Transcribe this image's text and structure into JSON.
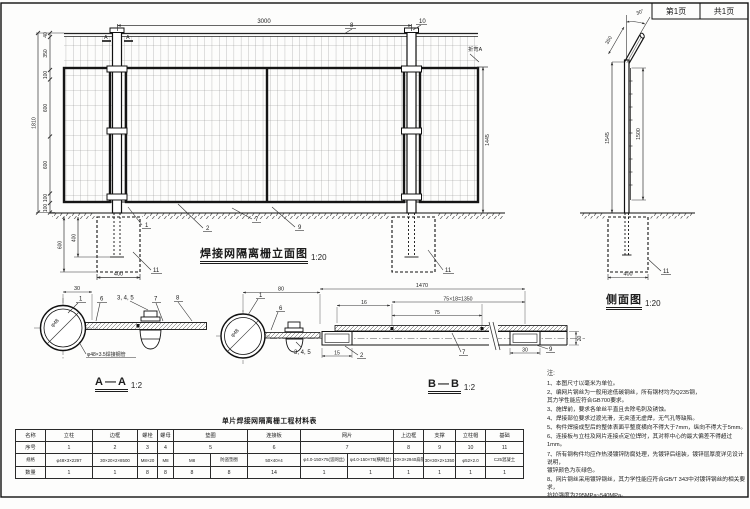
{
  "header": {
    "page": "第1页",
    "total": "共1页"
  },
  "elevation": {
    "title": "焊接网隔离栅立面图",
    "scale": "1:20",
    "dim_top": "3000",
    "dims_left": [
      "40",
      "350",
      "100",
      "600",
      "600",
      "100",
      "100"
    ],
    "dim_overall": "1810",
    "dim_right": "1445",
    "bend_label": "折弯A",
    "cut_a": "A",
    "callouts": {
      "c8": "8",
      "c10": "10",
      "c1": "1",
      "c2": "2",
      "c7": "7",
      "c9": "9",
      "c11l": "11",
      "c11r": "11"
    },
    "found": {
      "embed": "400",
      "depth": "600",
      "width": "400"
    }
  },
  "side": {
    "title": "侧面图",
    "scale": "1:20",
    "angle": "30°",
    "bend_len": "350",
    "h_post": "1545",
    "h_mesh": "1500",
    "found_width": "400",
    "c11": "11"
  },
  "aa": {
    "title": "A—A",
    "scale": "1:2",
    "dim30": "30",
    "pipe": "φ48",
    "pipe_label": "φ48×3.5焊接钢管",
    "callouts": {
      "c1": "1",
      "c6": "6",
      "c345": "3, 4, 5",
      "c7": "7",
      "c8": "8"
    }
  },
  "bb": {
    "title": "B—B",
    "scale": "1:2",
    "pipe": "φ48",
    "dims": {
      "d80": "80",
      "d1470": "1470",
      "d16": "16",
      "d1350": "75×18=1350",
      "d75": "75",
      "d15": "15",
      "d30": "30",
      "d20": "20"
    },
    "callouts": {
      "c1": "1",
      "c6": "6",
      "c345": "3, 4, 5",
      "c2": "2",
      "c7": "7",
      "c9": "9"
    }
  },
  "notes": {
    "heading": "注:",
    "items": [
      "1、本图尺寸以毫米为单位。",
      "2、编网片钢丝为一般用途低碳钢丝，所有钢材均为Q235钢，\n其力学性能应符合GB700要求。",
      "3、施焊前，要求各单丝平直且去除毛刺及锈蚀。",
      "4、焊接部位要求过渡光滑，无夹渣无虚焊，无气孔等缺陷。",
      "5、构件焊接成型后的整体表面平整度横向不得大于7mm，纵向不得大于5mm。",
      "6、连接板与立柱及网片连接点定位焊时，其对称中心的最大偏差不得超过1mm。",
      "7、所有钢构件均应作热浸镀锌防腐处理，先镀锌后组装，镀锌层厚度详见设计说明，\n镀锌颜色为灰绿色。",
      "8、网片钢丝采用镀锌钢丝，其力学性能应符合GB/T 343中对镀锌钢丝的相关要求，\n抗拉强度为295MPa~540MPa。"
    ]
  },
  "table": {
    "title": "单片焊接网隔离栅工程材料表",
    "row_labels": [
      "名称",
      "序号",
      "规格",
      "数量"
    ],
    "names": [
      "立柱",
      "边框",
      "螺栓",
      "螺母",
      "垫圈",
      "连接板",
      "网片",
      "上边框",
      "支撑",
      "立柱帽",
      "基础"
    ],
    "numbers": [
      "1",
      "2",
      "3",
      "4",
      "5",
      "6",
      "7",
      "8",
      "9",
      "10",
      "11"
    ],
    "specs": [
      "φ48×3×2297",
      "30×20×2×8500",
      "M8×20",
      "M8",
      "M8",
      "防盗垫圈",
      "50×40×4",
      "φ4.0-150×75(竖网丝)",
      "φ4.0-150×75(横网丝)",
      "20×3×2940扁钢",
      "30×30×2×1350",
      "φ52×2.0",
      "C25混凝土"
    ],
    "qtys": [
      "1",
      "1",
      "8",
      "8",
      "8",
      "8",
      "14",
      "1",
      "1",
      "1",
      "1",
      "1",
      "1"
    ]
  }
}
